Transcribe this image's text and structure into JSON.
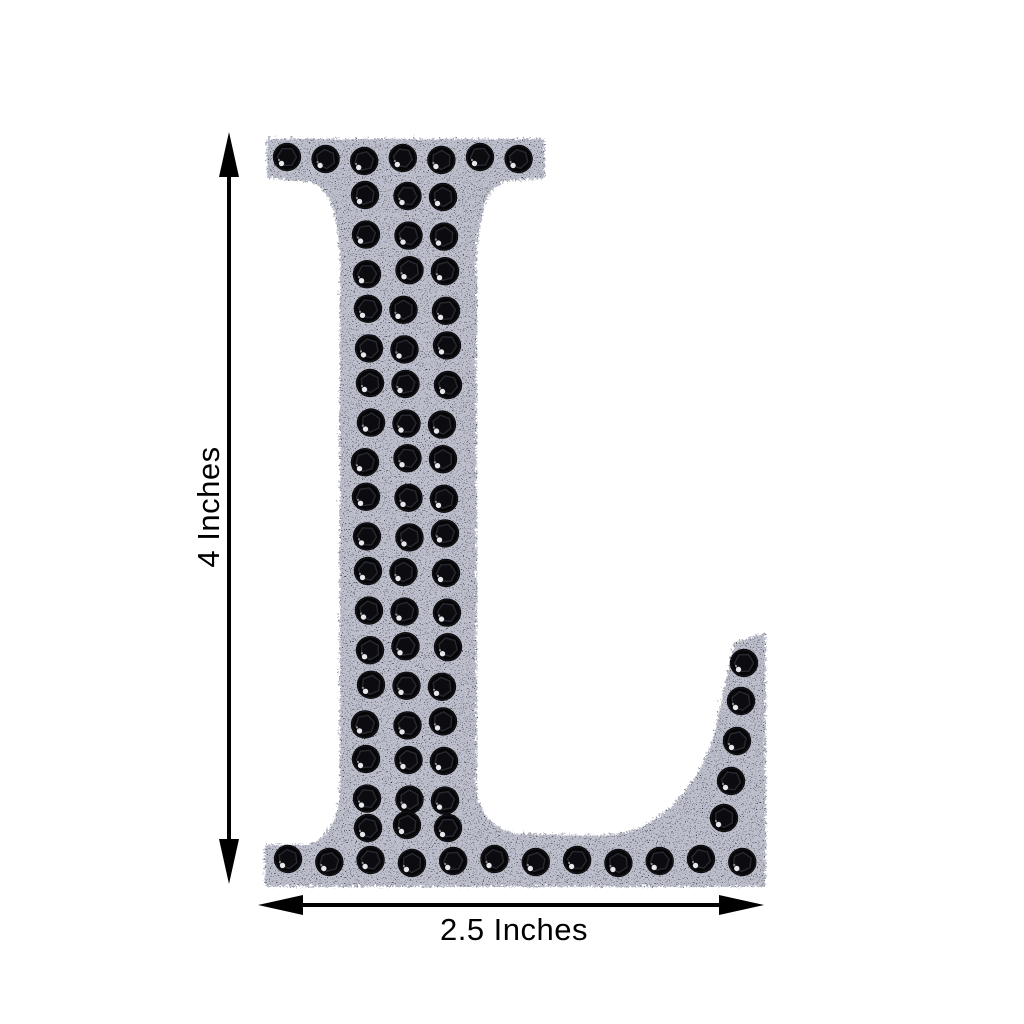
{
  "page": {
    "background_color": "#ffffff",
    "description": "Product size diagram of a self-adhesive black glitter rhinestone alphabet letter"
  },
  "product": {
    "letter": "L",
    "style": "serif capital letter with glitter foam body and black rhinestone studs",
    "colors": {
      "glitter_base": "#1d1e22",
      "glitter_speckle_dim": "#55575e",
      "glitter_speckle_bright": "#bcbec6",
      "rhinestone": "#060608",
      "rhinestone_facet": "#2a2b33",
      "rhinestone_core": "#0d0d11",
      "rhinestone_highlight": "#e6e7ec"
    },
    "rhinestones": {
      "top_row_count": 7,
      "stem_rows": 17,
      "stem_columns": 3,
      "pre_baseline_row_count": 3,
      "baseline_row_count": 12,
      "terminal_column_count": 5
    }
  },
  "annotations": {
    "height": {
      "label": "4 Inches"
    },
    "width": {
      "label": "2.5 Inches"
    },
    "arrow_color": "#000000",
    "label_color": "#000000"
  }
}
